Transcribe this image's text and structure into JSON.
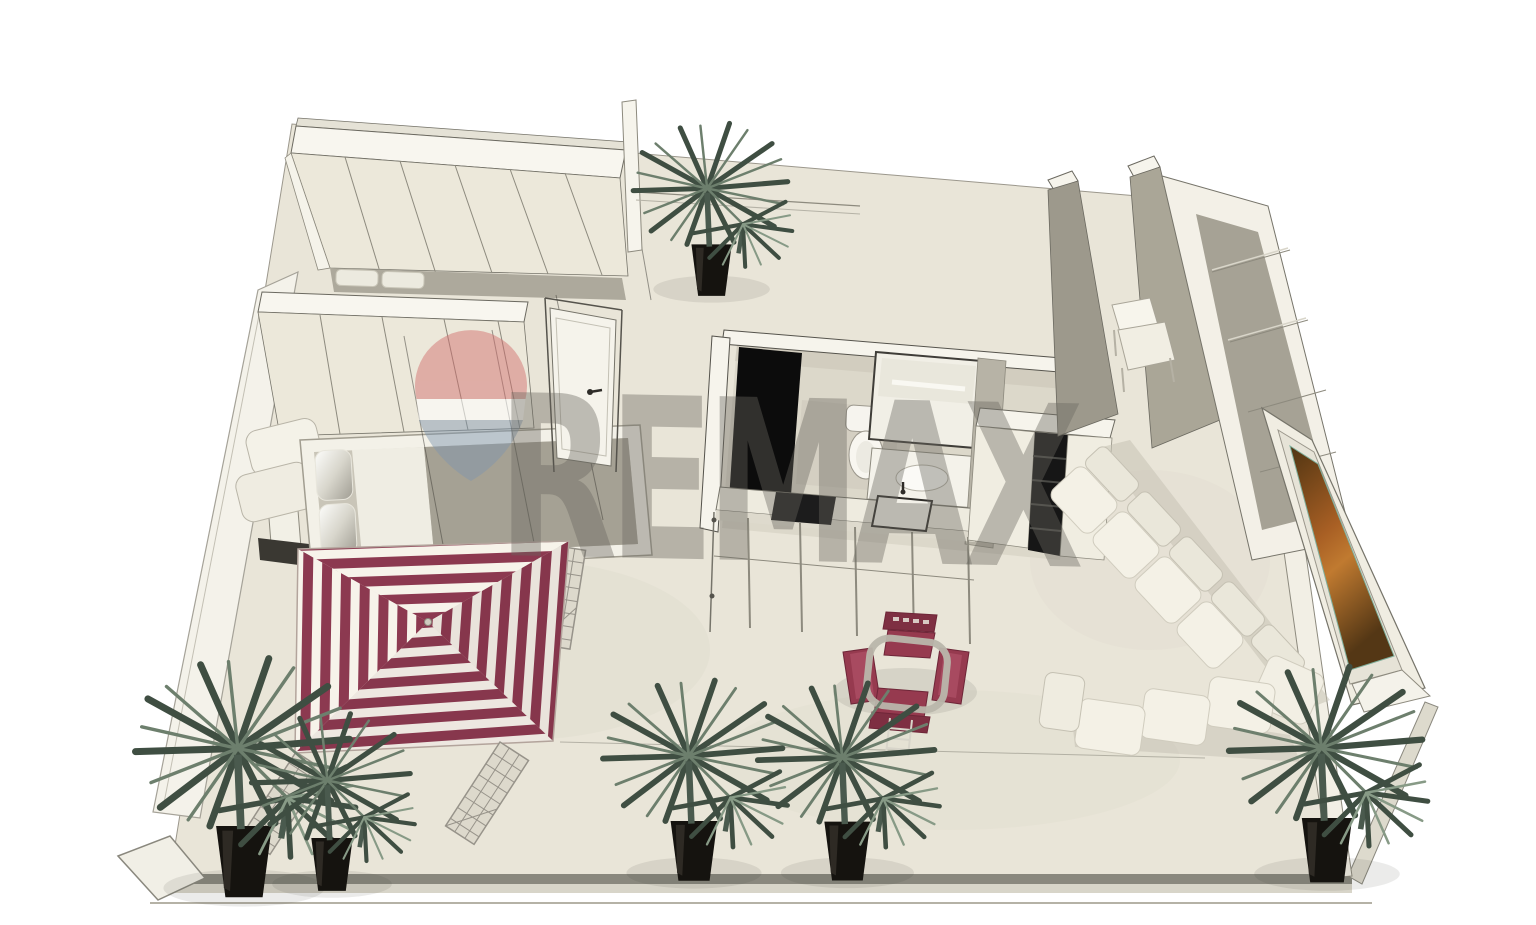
{
  "meta": {
    "title": "3D apartment floor plan rendering",
    "view": "isometric dollhouse top view",
    "background": "#ffffff"
  },
  "watermark": {
    "text": "REMAX",
    "text_color": "rgba(106,102,94,0.40)",
    "balloon": {
      "top_color": "rgba(207,106,106,0.55)",
      "band_color": "rgba(255,255,255,0.65)",
      "bottom_color": "rgba(125,150,175,0.55)"
    }
  },
  "palette": {
    "floor": "#e9e5d8",
    "floor_tile_bath": "#dcd8ca",
    "wall_cap": "#f7f5ee",
    "wall_face": "#ece8da",
    "wall_side_gray": "#a39f93",
    "outline": "#55534c",
    "black_panel": "#0c0c0c",
    "canopy_maroon": "#8c3950",
    "canopy_white": "#f7f3ea",
    "chair_red": "#963a4f",
    "sofa_white": "#f3f0e5",
    "window_amber": "#a85f24",
    "plant_dark": "#3f4e42",
    "plant_light": "#6d7f6d",
    "pot_black": "#15130f",
    "slab_edge_gray": "#8a887e"
  },
  "scene": {
    "objects": [
      {
        "name": "wardrobe-wall-upper",
        "type": "closet-row"
      },
      {
        "name": "wardrobe-wall-lower",
        "type": "closet-row"
      },
      {
        "name": "double-bed",
        "type": "bed",
        "pillows": 2
      },
      {
        "name": "bedroom-bench",
        "type": "white seat with dark base"
      },
      {
        "name": "striped-canopy-pergola",
        "stripes": [
          "#8c3950",
          "#f7f3ea"
        ],
        "legs": "lattice"
      },
      {
        "name": "entrance-door",
        "state": "open"
      },
      {
        "name": "bathroom",
        "fixtures": [
          "black-shower-panel",
          "toilet",
          "mirror",
          "vanity-sink"
        ]
      },
      {
        "name": "kitchen-counter",
        "appliances": [
          "cooktop",
          "sink"
        ]
      },
      {
        "name": "black-open-shelving"
      },
      {
        "name": "right-wall-wardrobes"
      },
      {
        "name": "white-armchair"
      },
      {
        "name": "amber-glass-window"
      },
      {
        "name": "white-sectional-sofa"
      },
      {
        "name": "dining-set",
        "chairs": 4,
        "chair_color": "#963a4f",
        "table": "round metal-frame"
      },
      {
        "name": "potted-palm",
        "count": 6
      }
    ]
  }
}
